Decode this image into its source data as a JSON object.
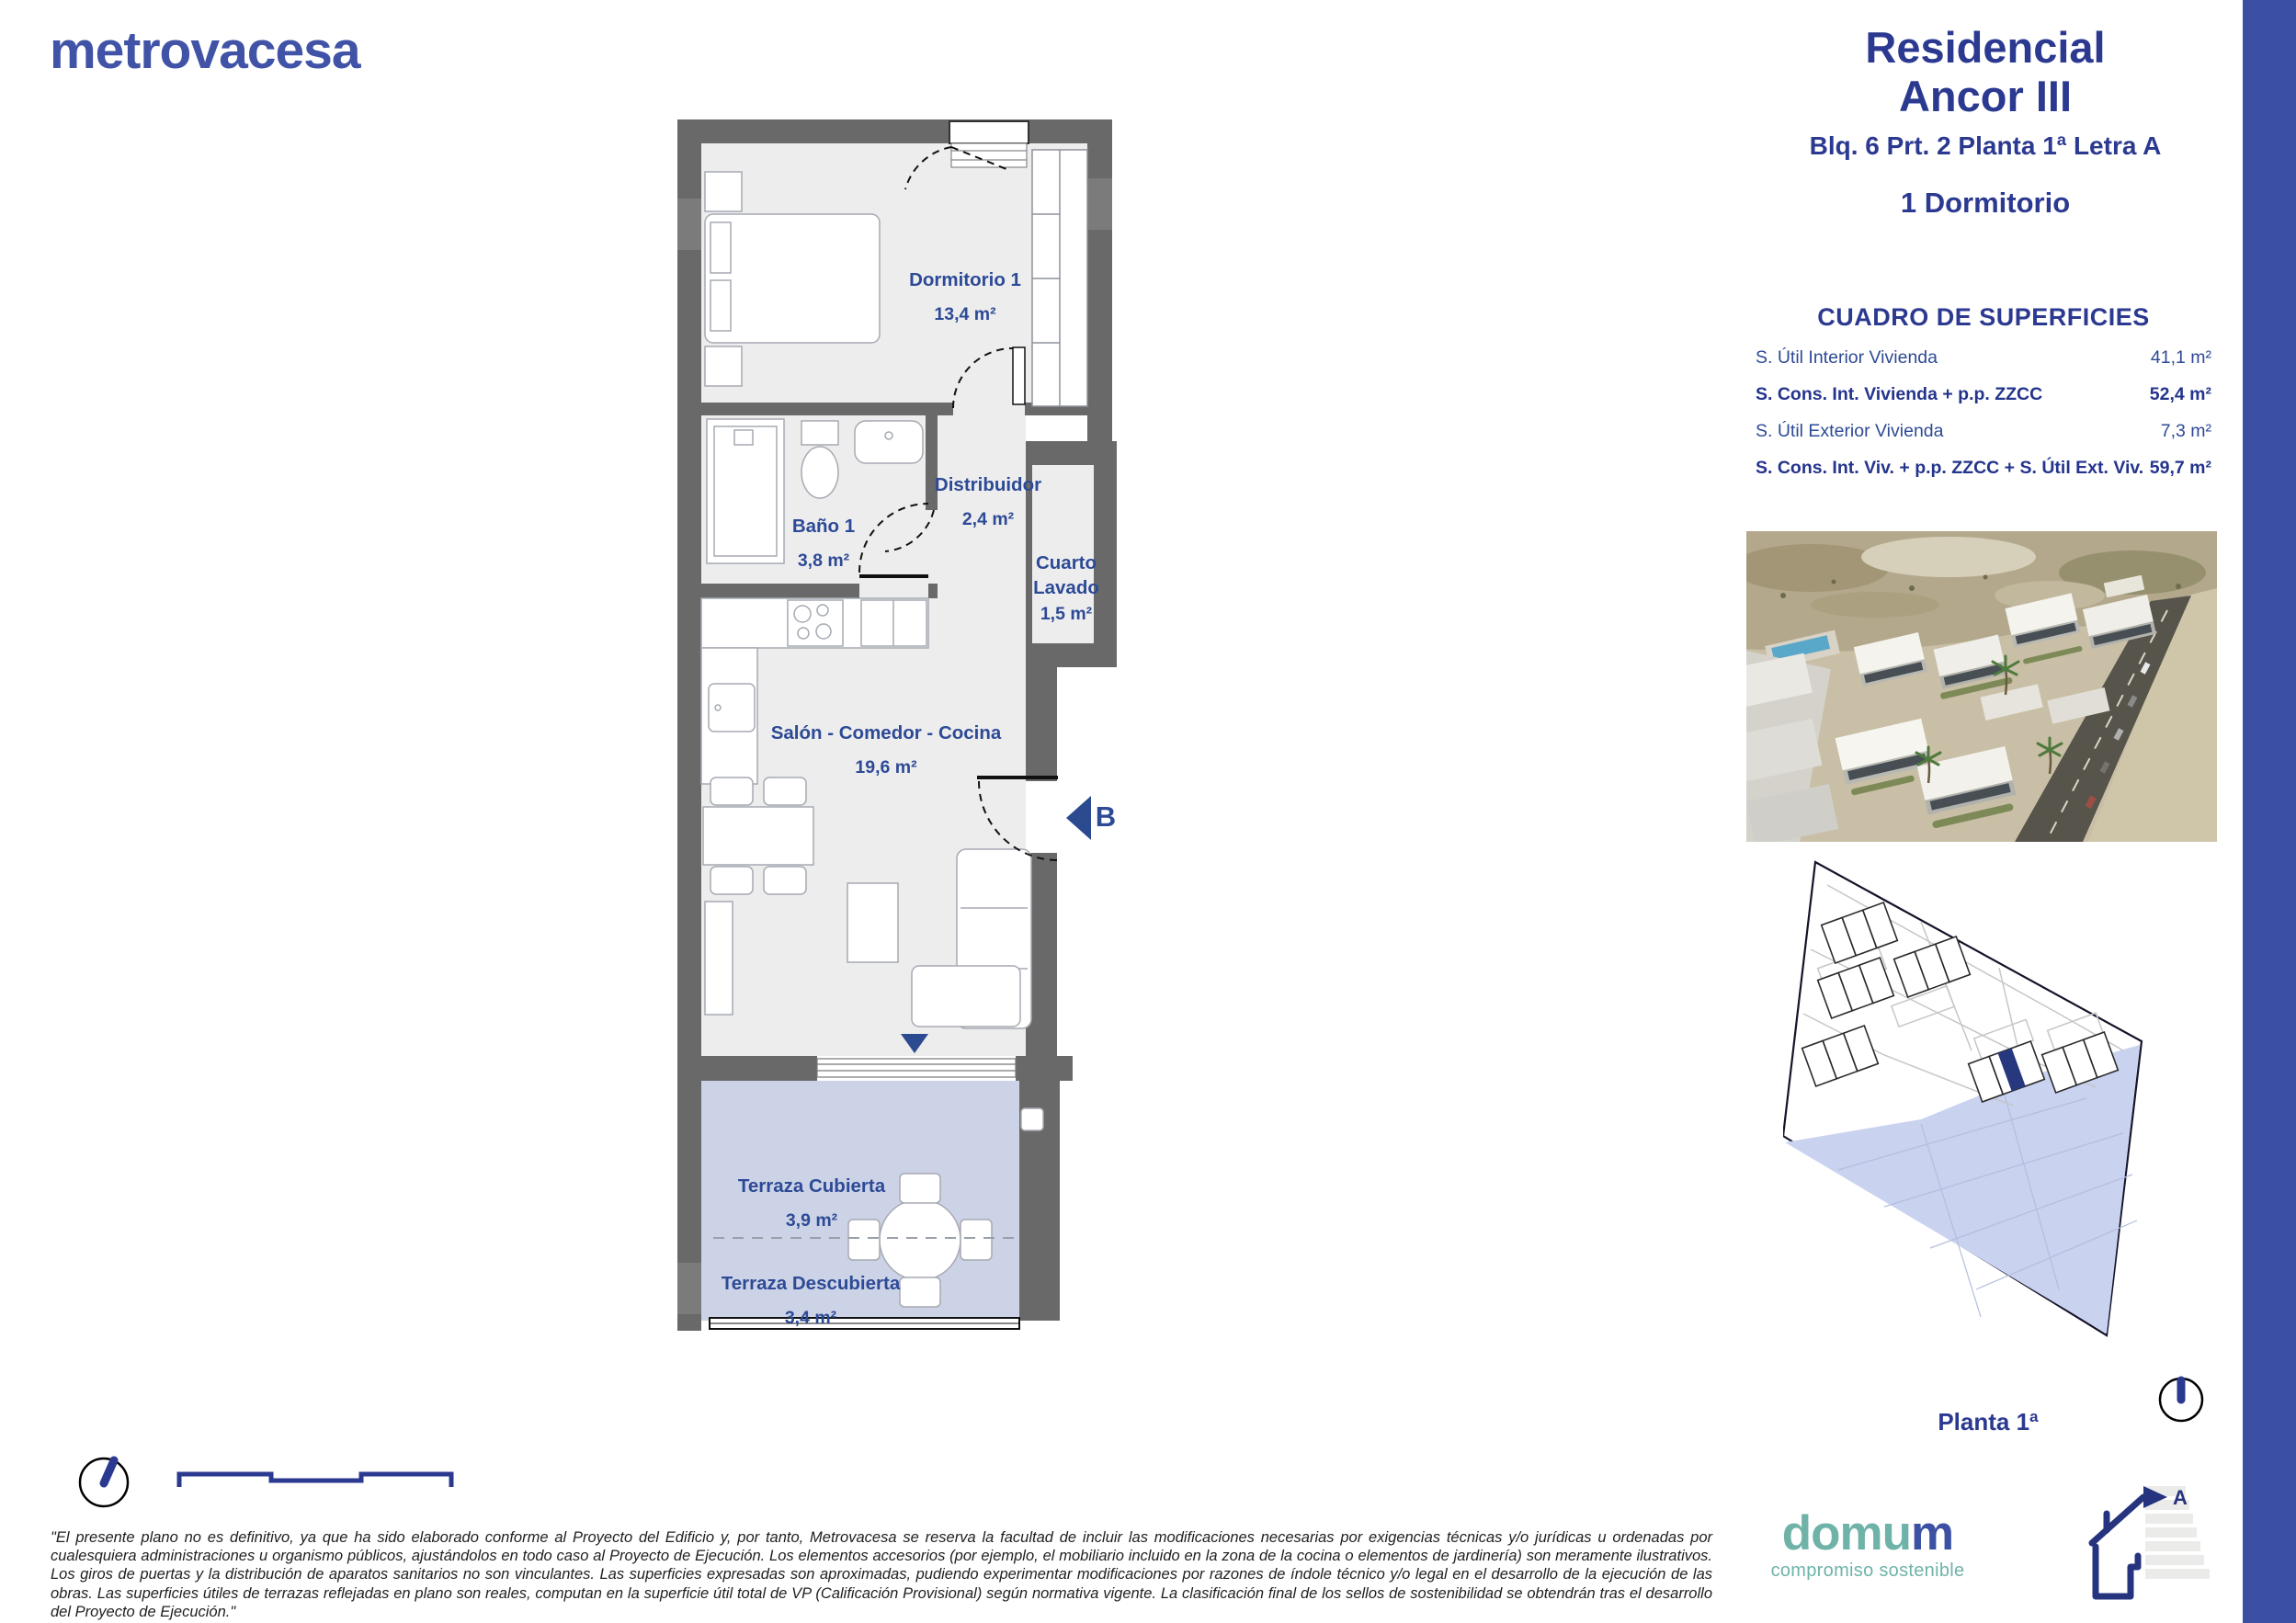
{
  "brand": {
    "name": "metrovacesa"
  },
  "header": {
    "title_line1": "Residencial",
    "title_line2": "Ancor III",
    "subtitle": "Blq. 6 Prt. 2 Planta 1ª Letra A",
    "dwelling_type": "1 Dormitorio"
  },
  "surfaces": {
    "title": "CUADRO DE SUPERFICIES",
    "rows": [
      {
        "label": "S. Útil Interior Vivienda",
        "value": "41,1 m²",
        "bold": false
      },
      {
        "label": "S. Cons. Int. Vivienda + p.p. ZZCC",
        "value": "52,4 m²",
        "bold": true
      },
      {
        "label": "S. Útil Exterior Vivienda",
        "value": "7,3 m²",
        "bold": false
      },
      {
        "label": "S. Cons. Int. Viv. + p.p. ZZCC + S. Útil Ext. Viv.",
        "value": "59,7 m²",
        "bold": true
      }
    ]
  },
  "floorplan": {
    "rooms": {
      "dormitorio": {
        "name": "Dormitorio 1",
        "area": "13,4 m²"
      },
      "bano": {
        "name": "Baño 1",
        "area": "3,8 m²"
      },
      "distribuidor": {
        "name": "Distribuidor",
        "area": "2,4 m²"
      },
      "lavado": {
        "name": "Cuarto Lavado",
        "area": "1,5 m²"
      },
      "salon": {
        "name": "Salón - Comedor - Cocina",
        "area": "19,6 m²"
      },
      "terraza_cubierta": {
        "name": "Terraza Cubierta",
        "area": "3,9 m²"
      },
      "terraza_descubierta": {
        "name": "Terraza Descubierta",
        "area": "3,4 m²"
      }
    },
    "entrance_label": "B"
  },
  "siteplan": {
    "caption": "Planta 1ª"
  },
  "energy": {
    "rating": "A"
  },
  "domum": {
    "word_main": "domu",
    "word_accent": "m",
    "tagline": "compromiso sostenible"
  },
  "disclaimer": "\"El presente plano no es definitivo, ya que ha sido elaborado conforme al Proyecto del Edificio y, por tanto, Metrovacesa se reserva la facultad de incluir las modificaciones necesarias por exigencias técnicas y/o jurídicas u ordenadas por cualesquiera administraciones u organismo públicos, ajustándolos en todo caso al Proyecto de Ejecución. Los elementos accesorios (por ejemplo, el mobiliario incluido en la zona de la cocina o elementos de jardinería) son meramente ilustrativos. Los giros de puertas y la distribución de aparatos sanitarios no son vinculantes. Las superficies expresadas son aproximadas, pudiendo experimentar modificaciones por razones de índole técnico y/o legal en el desarrollo de la ejecución de las obras. Las superficies útiles de terrazas reflejadas en plano son reales, computan en la superficie útil total de VP (Calificación Provisional) según normativa vigente. La clasificación final de los sellos de sostenibilidad se obtendrán tras el desarrollo del Proyecto de Ejecución.\"",
  "colors": {
    "navy": "#2b3990",
    "logo_blue": "#4053a6",
    "accent_bar": "#3b50a5",
    "teal": "#6fb3a8",
    "wall_gray": "#696969",
    "floor": "#ededee",
    "terrace": "#cdd3e6",
    "water": "#c9d2ef",
    "unit_highlight": "#27387e"
  }
}
